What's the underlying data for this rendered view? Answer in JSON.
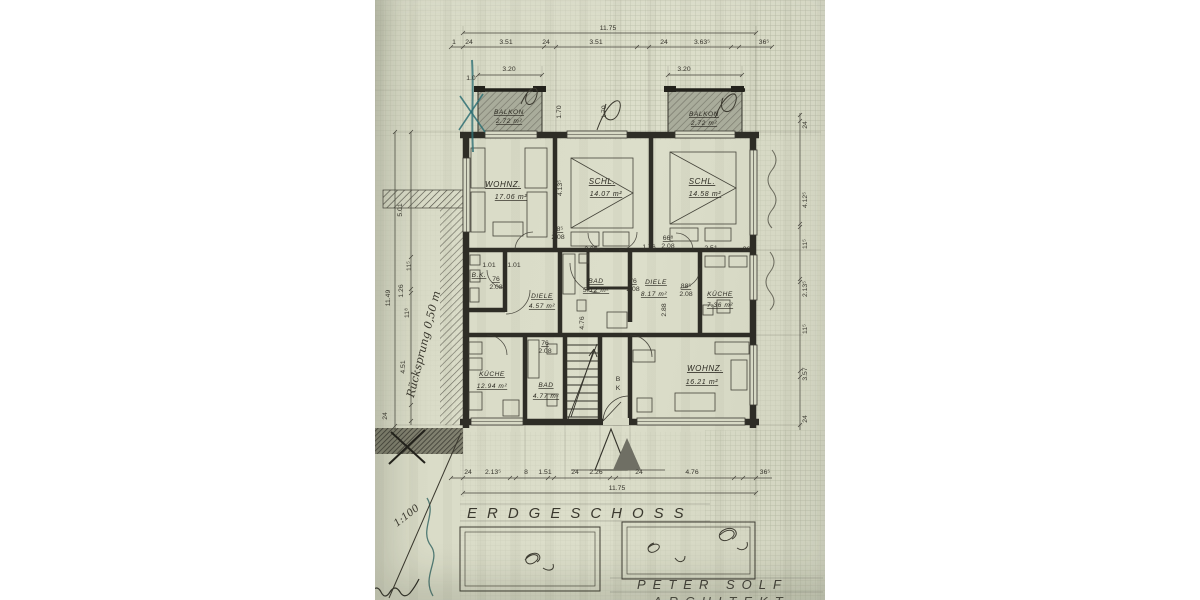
{
  "palette": {
    "paper": "#d7d9c5",
    "ink": "#35332b",
    "wall": "#2e2d26",
    "teal_pen": "#2e6f74",
    "shade_gray": "#9fa293"
  },
  "title": "ERDGESCHOSS",
  "architect": {
    "name": "PETER SOLF",
    "title": "ARCHITEKT"
  },
  "scale_note": "1:100",
  "annotations": {
    "setback": "Rücksprung 0,50 m"
  },
  "totals": {
    "top": "11.75",
    "bottom": "11.75",
    "left": "11.49"
  },
  "rooms": [
    {
      "name": "BALKON",
      "area": "2.72 m²"
    },
    {
      "name": "BALKON",
      "area": "2.72 m²"
    },
    {
      "name": "WOHNZ.",
      "area": "17.06 m²"
    },
    {
      "name": "SCHL.",
      "area": "14.07 m²"
    },
    {
      "name": "SCHL.",
      "area": "14.58 m²"
    },
    {
      "name": "B.K.",
      "area": ""
    },
    {
      "name": "DIELE",
      "area": "4.57 m²"
    },
    {
      "name": "BAD",
      "area": "5.12 m²"
    },
    {
      "name": "DIELE",
      "area": "8.17 m²"
    },
    {
      "name": "KÜCHE",
      "area": "7.36 m²"
    },
    {
      "name": "KÜCHE",
      "area": "12.94 m²"
    },
    {
      "name": "BAD",
      "area": "4.77 m²"
    },
    {
      "name": "WOHNZ.",
      "area": "16.21 m²"
    }
  ],
  "plan_labels": [
    {
      "t": "1",
      "x": 79,
      "y": 44,
      "s": 6
    },
    {
      "t": "24",
      "x": 94,
      "y": 44
    },
    {
      "t": "3.51",
      "x": 131,
      "y": 44
    },
    {
      "t": "24",
      "x": 171,
      "y": 44
    },
    {
      "t": "3.51",
      "x": 221,
      "y": 44
    },
    {
      "t": "24",
      "x": 289,
      "y": 44
    },
    {
      "t": "3.63⁵",
      "x": 327,
      "y": 44
    },
    {
      "t": "36⁵",
      "x": 389,
      "y": 44
    },
    {
      "t": "3.20",
      "x": 134,
      "y": 71
    },
    {
      "t": "1.0",
      "x": 96,
      "y": 80,
      "s": 6
    },
    {
      "t": "3.20",
      "x": 309,
      "y": 71
    },
    {
      "t": "1.70",
      "x": 186,
      "y": 112,
      "r": -90
    },
    {
      "t": "1.70",
      "x": 231,
      "y": 112,
      "r": -90
    },
    {
      "t": "4.13⁵",
      "x": 187,
      "y": 188,
      "r": -90
    },
    {
      "t": "1.01",
      "x": 114,
      "y": 267,
      "s": 6
    },
    {
      "t": "1.01",
      "x": 139,
      "y": 267,
      "s": 6
    },
    {
      "t": "2.35",
      "x": 216,
      "y": 251,
      "s": 6.5
    },
    {
      "t": "1.76",
      "x": 274,
      "y": 249,
      "s": 6.5
    },
    {
      "t": "2.51",
      "x": 336,
      "y": 250,
      "s": 6.5
    },
    {
      "t": "36⁵",
      "x": 373,
      "y": 251,
      "s": 6
    },
    {
      "t": "2.88",
      "x": 291,
      "y": 310,
      "r": -90,
      "s": 6.5
    },
    {
      "t": "4.76",
      "x": 209,
      "y": 323,
      "r": -90,
      "s": 6.5
    },
    {
      "t": "88⁵",
      "x": 183,
      "y": 231,
      "s": 5.5,
      "u": 1
    },
    {
      "t": "2.08",
      "x": 183,
      "y": 239,
      "s": 5.5
    },
    {
      "t": "66⁸",
      "x": 293,
      "y": 240,
      "s": 5.5,
      "u": 1
    },
    {
      "t": "2.08",
      "x": 293,
      "y": 248,
      "s": 5.5
    },
    {
      "t": "76",
      "x": 121,
      "y": 281,
      "s": 5.5,
      "u": 1
    },
    {
      "t": "2.08",
      "x": 121,
      "y": 289,
      "s": 5.5
    },
    {
      "t": "76",
      "x": 258,
      "y": 283,
      "s": 5.5,
      "u": 1
    },
    {
      "t": "2.08",
      "x": 258,
      "y": 291,
      "s": 5.5
    },
    {
      "t": "88⁵",
      "x": 311,
      "y": 288,
      "s": 5.5,
      "u": 1
    },
    {
      "t": "2.08",
      "x": 311,
      "y": 296,
      "s": 5.5
    },
    {
      "t": "76",
      "x": 170,
      "y": 345,
      "s": 5.5,
      "u": 1
    },
    {
      "t": "2.08",
      "x": 170,
      "y": 353,
      "s": 5.5
    },
    {
      "t": "B",
      "x": 243,
      "y": 381,
      "s": 6.5
    },
    {
      "t": "K",
      "x": 243,
      "y": 390,
      "s": 6.5
    },
    {
      "t": "24",
      "x": 93,
      "y": 474
    },
    {
      "t": "2.13⁵",
      "x": 118,
      "y": 474
    },
    {
      "t": "8",
      "x": 151,
      "y": 474,
      "s": 5.5
    },
    {
      "t": "1.51",
      "x": 170,
      "y": 474
    },
    {
      "t": "24",
      "x": 200,
      "y": 474
    },
    {
      "t": "2.26",
      "x": 221,
      "y": 474
    },
    {
      "t": "24",
      "x": 264,
      "y": 474
    },
    {
      "t": "4.76",
      "x": 317,
      "y": 474
    },
    {
      "t": "36⁵",
      "x": 390,
      "y": 474
    },
    {
      "t": "5.01",
      "x": 27,
      "y": 210,
      "r": -90
    },
    {
      "t": "11⁵",
      "x": 36,
      "y": 266,
      "r": -90,
      "s": 6
    },
    {
      "t": "1.26",
      "x": 28,
      "y": 291,
      "r": -90
    },
    {
      "t": "11⁸",
      "x": 34,
      "y": 313,
      "r": -90,
      "s": 6
    },
    {
      "t": "4.51",
      "x": 30,
      "y": 367,
      "r": -90
    },
    {
      "t": "24",
      "x": 12,
      "y": 416,
      "r": -90,
      "s": 6
    },
    {
      "t": "24",
      "x": 432,
      "y": 125,
      "r": -90,
      "s": 6
    },
    {
      "t": "4.12⁵",
      "x": 432,
      "y": 200,
      "r": -90
    },
    {
      "t": "11⁵",
      "x": 432,
      "y": 244,
      "r": -90,
      "s": 6
    },
    {
      "t": "2.13⁵",
      "x": 432,
      "y": 289,
      "r": -90
    },
    {
      "t": "11⁵",
      "x": 432,
      "y": 329,
      "r": -90,
      "s": 6
    },
    {
      "t": "3.57",
      "x": 432,
      "y": 374,
      "r": -90
    },
    {
      "t": "24",
      "x": 432,
      "y": 419,
      "r": -90,
      "s": 6
    }
  ]
}
